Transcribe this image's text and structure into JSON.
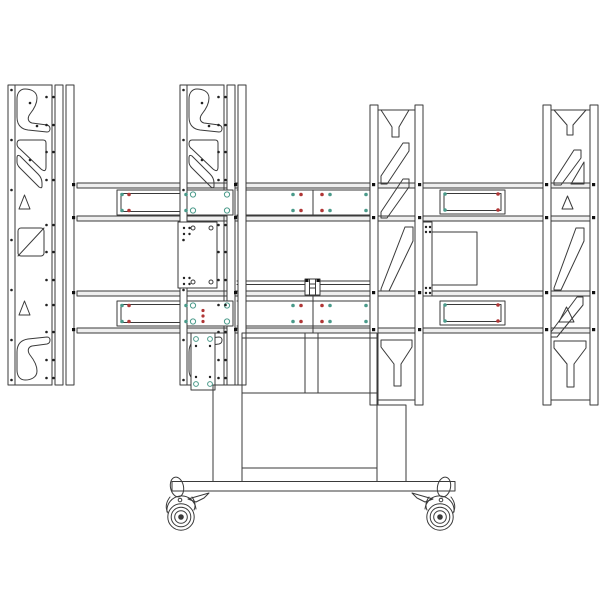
{
  "colors": {
    "background": "#ffffff",
    "line": "#3a3a3a",
    "rail_fill": "#efefef",
    "dot_red": "#b03636",
    "dot_teal": "#4a9a8a",
    "dot_black": "#222222",
    "junction": "#111111"
  },
  "components": {
    "drawing": "mobile-video-wall-cart-technical-drawing",
    "columns": [
      "vesa-column-left-outer",
      "vesa-column-left-inner",
      "vesa-column-right-inner",
      "vesa-column-right-outer"
    ],
    "rails": [
      "top-crossbar-rail",
      "bottom-crossbar-rail"
    ],
    "center": [
      "center-clamp-bracket",
      "side-plate-right",
      "mounting-plate-inner"
    ],
    "base": [
      "pedestal-cabinet",
      "left-leg",
      "right-leg",
      "base-frame",
      "caster-left",
      "caster-right"
    ]
  }
}
